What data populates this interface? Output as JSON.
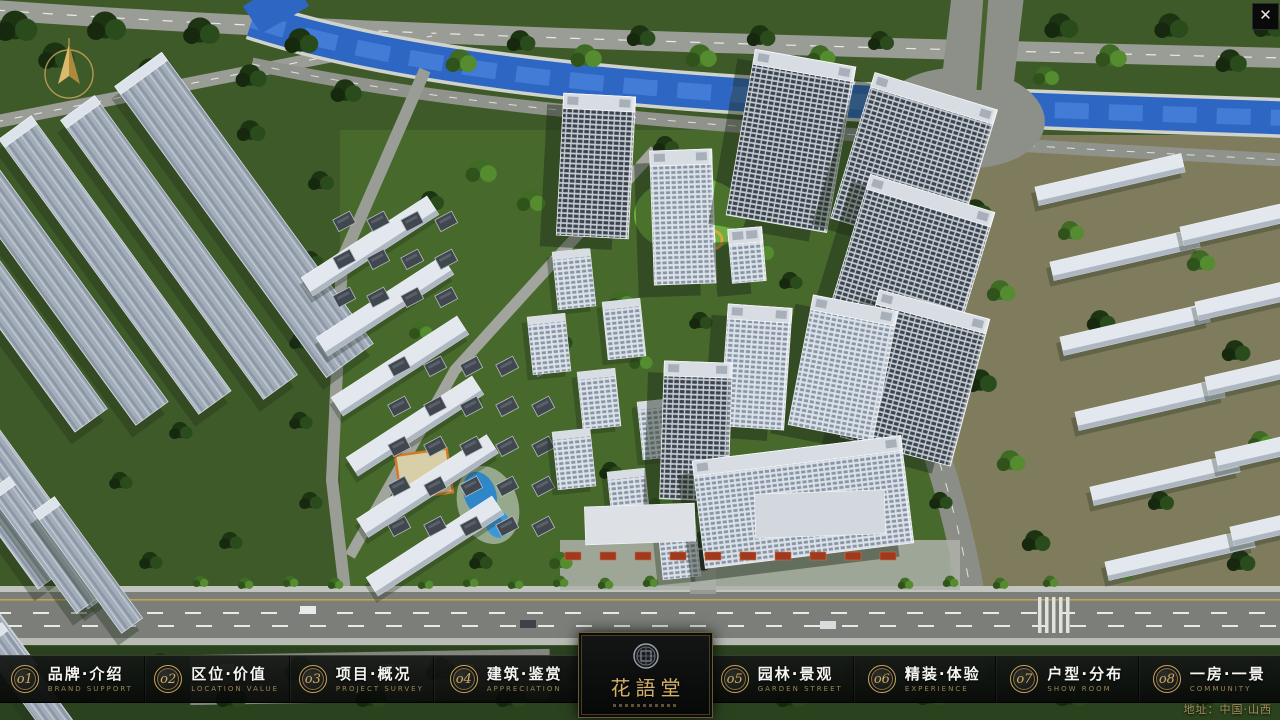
{
  "window": {
    "close_glyph": "✕"
  },
  "scene": {
    "description": "aerial 3D masterplan render of residential community"
  },
  "logo": {
    "title": "花語堂"
  },
  "navbar": {
    "items": [
      {
        "num": "o1",
        "label": "品牌·介绍",
        "sub": "BRAND SUPPORT"
      },
      {
        "num": "o2",
        "label": "区位·价值",
        "sub": "LOCATION VALUE"
      },
      {
        "num": "o3",
        "label": "项目·概况",
        "sub": "PROJECT SURVEY"
      },
      {
        "num": "o4",
        "label": "建筑·鉴赏",
        "sub": "APPRECIATION"
      },
      {
        "num": "o5",
        "label": "园林·景观",
        "sub": "GARDEN STREET"
      },
      {
        "num": "o6",
        "label": "精装·体验",
        "sub": "EXPERIENCE"
      },
      {
        "num": "o7",
        "label": "户型·分布",
        "sub": "SHOW ROOM"
      },
      {
        "num": "o8",
        "label": "一房·一景",
        "sub": "COMMUNITY"
      }
    ]
  },
  "footer": {
    "address": "地址：中国·山西"
  },
  "colors": {
    "gold": "#c9a35f",
    "navbar_bg": "#0c0e0d",
    "river": "#2e66c4",
    "grass": "#3f5a29"
  }
}
